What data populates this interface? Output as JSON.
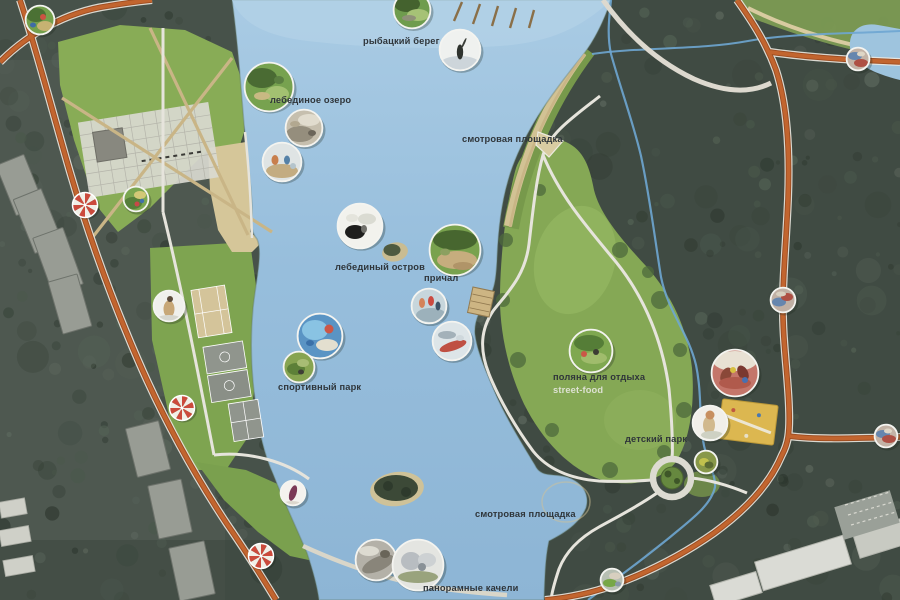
{
  "map": {
    "type": "park-masterplan",
    "colors": {
      "water": "#9ac0dc",
      "water_shallow": "#b5d3e8",
      "forest": "#3f4a41",
      "lawn": "#85a955",
      "sand": "#d2c294",
      "road_orange": "#c2652f",
      "road_casing": "#ebe8e0",
      "stream_blue": "#6ea6d2",
      "umbrella_red": "#cb4a3c",
      "umbrella_white": "#f1efe7",
      "marker_ring": "#f4f4f0",
      "label_dark": "#2f353a",
      "label_light": "#dde1d2"
    },
    "labels": [
      {
        "id": "fishing-shore",
        "text": "рыбацкий берег",
        "x": 363,
        "y": 44
      },
      {
        "id": "swan-lake",
        "text": "лебединое озеро",
        "x": 270,
        "y": 103
      },
      {
        "id": "viewpoint-north",
        "text": "смотровая площадка",
        "x": 462,
        "y": 142
      },
      {
        "id": "swan-island",
        "text": "лебединый остров",
        "x": 335,
        "y": 270
      },
      {
        "id": "pier",
        "text": "причал",
        "x": 424,
        "y": 281
      },
      {
        "id": "sports-park",
        "text": "спортивный парк",
        "x": 278,
        "y": 390
      },
      {
        "id": "rest-glade",
        "text": "поляна для отдыха",
        "x": 553,
        "y": 380
      },
      {
        "id": "street-food",
        "text": "street-food",
        "x": 553,
        "y": 393,
        "light": true
      },
      {
        "id": "children-park",
        "text": "детский парк",
        "x": 625,
        "y": 442
      },
      {
        "id": "viewpoint-south",
        "text": "смотровая площадка",
        "x": 475,
        "y": 517
      },
      {
        "id": "panoramic-swings",
        "text": "панорамные качели",
        "x": 423,
        "y": 591
      }
    ],
    "photo_markers": [
      {
        "id": "corner-playground",
        "x": 40,
        "y": 20,
        "r": 15,
        "bg": "#74a04c",
        "blobs": [
          [
            -4,
            -5,
            10,
            7,
            "#4b7134"
          ],
          [
            5,
            6,
            8,
            5,
            "#c6b272"
          ],
          [
            3,
            -3,
            3,
            3,
            "#cb5242"
          ],
          [
            -7,
            5,
            3,
            2.5,
            "#3f6ca6"
          ]
        ]
      },
      {
        "id": "park-playground",
        "x": 136,
        "y": 199,
        "r": 13,
        "bg": "#7aa650",
        "blobs": [
          [
            -3,
            4,
            9,
            6,
            "#567f3a"
          ],
          [
            4,
            -4,
            6,
            4,
            "#d2c876"
          ],
          [
            1,
            5,
            2.5,
            2.5,
            "#c84848"
          ],
          [
            6,
            2,
            2.2,
            2.2,
            "#4070aa"
          ]
        ]
      },
      {
        "id": "fishing-shore-photo",
        "x": 412,
        "y": 10,
        "r": 19,
        "bg": "#6f9c4e",
        "blobs": [
          [
            -5,
            -6,
            13,
            8,
            "#44622e"
          ],
          [
            6,
            5,
            11,
            6,
            "#a6c276"
          ],
          [
            -3,
            8,
            7,
            3,
            "#8f9178"
          ]
        ]
      },
      {
        "id": "fisherman-photo",
        "x": 460,
        "y": 50,
        "r": 21,
        "bg": "#eff1ef",
        "blobs": [
          [
            0,
            14,
            20,
            8,
            "#cdd5da"
          ],
          [
            0,
            2,
            3.2,
            7.5,
            "#2f332e"
          ],
          [
            4,
            -7,
            1,
            5.5,
            "#3a3e38",
            25
          ]
        ]
      },
      {
        "id": "swan-lake-aerial",
        "x": 269,
        "y": 87,
        "r": 25,
        "bg": "#77a24f",
        "blobs": [
          [
            -7,
            -9,
            15,
            10,
            "#4a6b33"
          ],
          [
            8,
            7,
            12,
            8,
            "#a3c171"
          ],
          [
            -7,
            9,
            8,
            4,
            "#c8b983"
          ],
          [
            10,
            -7,
            5,
            4,
            "#5b7f41"
          ]
        ]
      },
      {
        "id": "deck-photo",
        "x": 304,
        "y": 128,
        "r": 19,
        "bg": "#c6bfae",
        "blobs": [
          [
            -4,
            6,
            14,
            8,
            "#958e7d"
          ],
          [
            5,
            -8,
            11,
            6,
            "#e1dcce"
          ],
          [
            8,
            5,
            4,
            3,
            "#6b6559"
          ],
          [
            -9,
            -4,
            5,
            3,
            "#b2a890"
          ]
        ]
      },
      {
        "id": "rowing-photo",
        "x": 282,
        "y": 162,
        "r": 20,
        "bg": "#dfe4e4",
        "blobs": [
          [
            0,
            9,
            16,
            7,
            "#c3ac81"
          ],
          [
            -7,
            -2,
            3.5,
            5,
            "#c87f4d"
          ],
          [
            5,
            -2,
            3,
            4.5,
            "#5581a7"
          ],
          [
            11,
            4,
            3,
            3,
            "#b4c4cc"
          ]
        ]
      },
      {
        "id": "swans-photo",
        "x": 360,
        "y": 226,
        "r": 23,
        "bg": "#f2f2ed",
        "blobs": [
          [
            -5,
            6,
            10,
            7,
            "#1e1e1c"
          ],
          [
            7,
            -7,
            9,
            5.5,
            "#dadbd2"
          ],
          [
            4,
            3,
            3,
            4,
            "#70706a"
          ],
          [
            -8,
            -8,
            6,
            4,
            "#e4e4dc"
          ]
        ]
      },
      {
        "id": "shore-park-photo",
        "x": 455,
        "y": 250,
        "r": 26,
        "bg": "#79a24e",
        "blobs": [
          [
            0,
            -10,
            22,
            10,
            "#47662f"
          ],
          [
            2,
            10,
            20,
            9,
            "#c6ad7e"
          ],
          [
            -10,
            2,
            5,
            3.5,
            "#8ca060"
          ],
          [
            8,
            16,
            10,
            4,
            "#b09468"
          ]
        ]
      },
      {
        "id": "sup-photo",
        "x": 429,
        "y": 306,
        "r": 18,
        "bg": "#c7d6dc",
        "blobs": [
          [
            2,
            9,
            15,
            7,
            "#9cb1bb"
          ],
          [
            -7,
            -3,
            3,
            5,
            "#d4835a"
          ],
          [
            2,
            -5,
            3,
            5,
            "#cb4a40"
          ],
          [
            9,
            0,
            2.5,
            4.5,
            "#3c5468"
          ]
        ]
      },
      {
        "id": "kayak-photo",
        "x": 452,
        "y": 341,
        "r": 20,
        "bg": "#dde5e8",
        "blobs": [
          [
            1,
            5,
            14,
            4.5,
            "#bf5043",
            -18
          ],
          [
            -5,
            -6,
            9,
            4,
            "#a3b1b9"
          ],
          [
            8,
            -3,
            4,
            3,
            "#cfd8dc"
          ]
        ]
      },
      {
        "id": "aquapark-aerial",
        "x": 320,
        "y": 336,
        "r": 23,
        "bg": "#5a94c4",
        "blobs": [
          [
            -5,
            -6,
            13,
            10,
            "#89c3e3"
          ],
          [
            7,
            9,
            11,
            6,
            "#e3dfcf"
          ],
          [
            9,
            -7,
            4.5,
            4.5,
            "#cb5747"
          ],
          [
            -10,
            7,
            4,
            3,
            "#3a70a8"
          ]
        ]
      },
      {
        "id": "sport-field-photo",
        "x": 299,
        "y": 367,
        "r": 16,
        "bg": "#87a451",
        "blobs": [
          [
            -3,
            2,
            9,
            6,
            "#5d8038"
          ],
          [
            4,
            -4,
            6,
            4,
            "#a8bc74"
          ],
          [
            2,
            5,
            3,
            2.5,
            "#3e3e36"
          ]
        ]
      },
      {
        "id": "runner-photo",
        "x": 169,
        "y": 306,
        "r": 16,
        "bg": "#f0f0ec",
        "blobs": [
          [
            0,
            3,
            5.5,
            8.5,
            "#c7a777"
          ],
          [
            1,
            -7,
            3,
            3,
            "#5c4c3c"
          ],
          [
            0,
            13,
            12,
            4,
            "#d6d6ce"
          ]
        ]
      },
      {
        "id": "picnic-photo",
        "x": 591,
        "y": 351,
        "r": 22,
        "bg": "#7fa850",
        "blobs": [
          [
            -2,
            -8,
            15,
            8,
            "#557d37"
          ],
          [
            3,
            7,
            13,
            6,
            "#a0bc6c"
          ],
          [
            -7,
            3,
            3,
            3,
            "#cb5747"
          ],
          [
            5,
            1,
            3,
            3,
            "#3c3c34"
          ]
        ]
      },
      {
        "id": "playground-equip-photo",
        "x": 735,
        "y": 373,
        "r": 24,
        "bg": "#c4766a",
        "blobs": [
          [
            0,
            -12,
            22,
            10,
            "#e8e1d3"
          ],
          [
            -9,
            2,
            5,
            8,
            "#8a4838",
            28
          ],
          [
            8,
            0,
            5,
            8,
            "#7a3830",
            -28
          ],
          [
            0,
            10,
            16,
            6,
            "#b05a4c"
          ],
          [
            -2,
            -3,
            3,
            3,
            "#d7bf40"
          ],
          [
            10,
            7,
            3,
            3,
            "#4870b0"
          ]
        ]
      },
      {
        "id": "child-photo",
        "x": 710,
        "y": 423,
        "r": 18,
        "bg": "#f1efe9",
        "blobs": [
          [
            -1,
            2,
            6,
            9,
            "#d1b98d"
          ],
          [
            0,
            -8,
            4.5,
            4.5,
            "#c78f5f"
          ],
          [
            2,
            12,
            11,
            4,
            "#ced1c3"
          ]
        ]
      },
      {
        "id": "green-spot-photo",
        "x": 706,
        "y": 462,
        "r": 12,
        "bg": "#88984a",
        "blobs": [
          [
            -2,
            0,
            5,
            4,
            "#c1c14d"
          ],
          [
            3,
            3,
            4.5,
            3.5,
            "#5b6b33"
          ]
        ]
      },
      {
        "id": "gymnast-photo",
        "x": 293,
        "y": 493,
        "r": 13,
        "bg": "#f4f2ee",
        "blobs": [
          [
            0,
            0,
            3.5,
            8,
            "#7b3957",
            18
          ],
          [
            -1,
            11,
            9,
            3,
            "#dcd7cd"
          ]
        ]
      },
      {
        "id": "boardwalk-photo",
        "x": 376,
        "y": 560,
        "r": 21,
        "bg": "#b4b1a8",
        "blobs": [
          [
            2,
            4,
            17,
            7,
            "#89857a",
            -24
          ],
          [
            -7,
            -9,
            10,
            5,
            "#dddbd1"
          ],
          [
            9,
            -6,
            5,
            4,
            "#696559"
          ]
        ]
      },
      {
        "id": "city-view-photo",
        "x": 418,
        "y": 565,
        "r": 26,
        "bg": "#e4e5e1",
        "blobs": [
          [
            -7,
            -4,
            10,
            9,
            "#b8bdc1"
          ],
          [
            9,
            -5,
            9,
            7,
            "#cdd1d3"
          ],
          [
            0,
            12,
            20,
            6,
            "#99a37d"
          ],
          [
            4,
            2,
            4,
            4,
            "#899197"
          ]
        ]
      },
      {
        "id": "junction-ne",
        "x": 858,
        "y": 59,
        "r": 12,
        "bg": "#c3b3a6",
        "blobs": [
          [
            -3,
            -3,
            7,
            4,
            "#6686ae"
          ],
          [
            3,
            4,
            7,
            4,
            "#ae5044"
          ],
          [
            3,
            -5,
            4,
            2.5,
            "#ded6c6"
          ]
        ]
      },
      {
        "id": "junction-east",
        "x": 783,
        "y": 300,
        "r": 13,
        "bg": "#c0b0a4",
        "blobs": [
          [
            -4,
            2,
            7,
            4.5,
            "#6686ae"
          ],
          [
            4,
            -3,
            6,
            4,
            "#ae5044"
          ],
          [
            -2,
            -6,
            5,
            2.5,
            "#d8d0c0"
          ]
        ]
      },
      {
        "id": "junction-se",
        "x": 886,
        "y": 436,
        "r": 12,
        "bg": "#c3b3a6",
        "blobs": [
          [
            -3,
            -2,
            7,
            4,
            "#6686ae"
          ],
          [
            3,
            3,
            7,
            4,
            "#ae5044"
          ],
          [
            2,
            -5,
            4,
            2.5,
            "#ded6c6"
          ]
        ]
      },
      {
        "id": "junction-south",
        "x": 612,
        "y": 580,
        "r": 12,
        "bg": "#b7bfb3",
        "blobs": [
          [
            -2,
            3,
            7,
            4,
            "#77a747"
          ],
          [
            3,
            -4,
            6,
            3.5,
            "#d7cfbf"
          ],
          [
            6,
            4,
            3,
            2.5,
            "#8898a8"
          ]
        ]
      }
    ],
    "umbrella_markers": [
      {
        "id": "entrance-umbrella-1",
        "x": 85,
        "y": 205
      },
      {
        "id": "entrance-umbrella-2",
        "x": 182,
        "y": 408
      },
      {
        "id": "entrance-umbrella-3",
        "x": 261,
        "y": 556
      }
    ]
  }
}
